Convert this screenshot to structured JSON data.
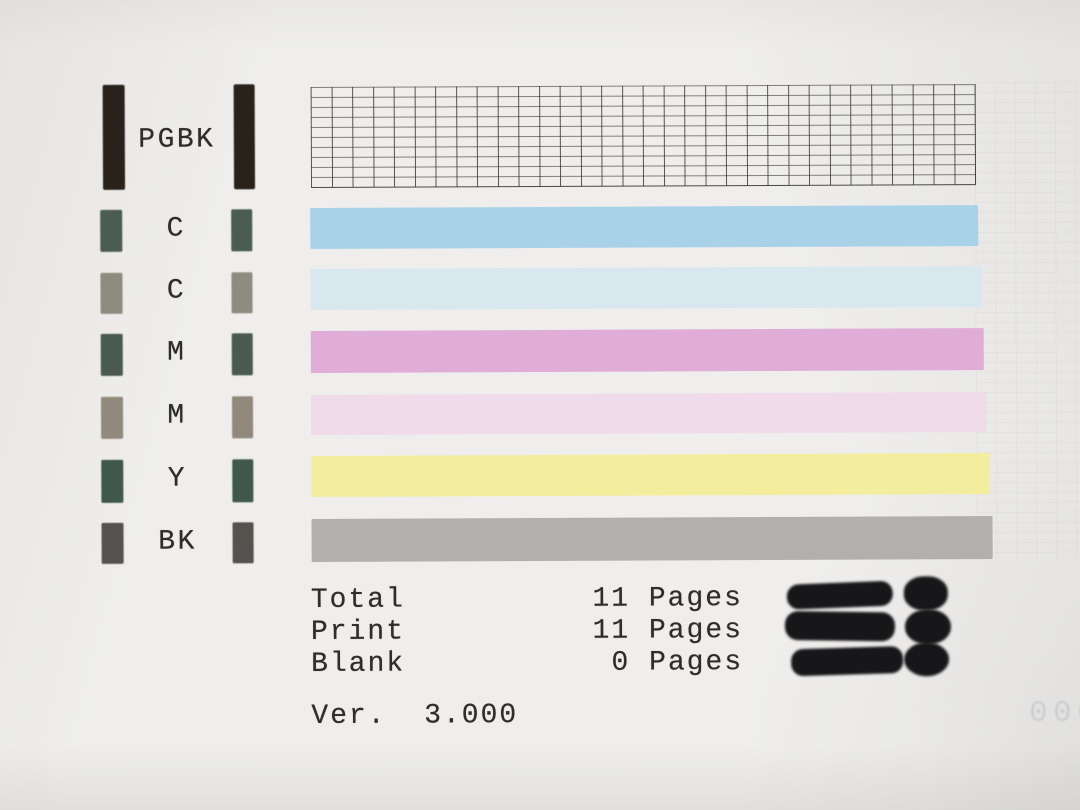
{
  "rows": [
    {
      "label": "PGBK",
      "marker_color": "#28221b",
      "bar_type": "grid"
    },
    {
      "label": "C",
      "marker_color": "#4b5c52",
      "bar_type": "solid",
      "bar_color": "#a9d2e8"
    },
    {
      "label": "C",
      "marker_color": "#8f8b7e",
      "bar_type": "solid",
      "bar_color": "#d9e8ee"
    },
    {
      "label": "M",
      "marker_color": "#4a5a50",
      "bar_type": "solid",
      "bar_color": "#dfadd7"
    },
    {
      "label": "M",
      "marker_color": "#91897c",
      "bar_type": "solid",
      "bar_color": "#efdbea"
    },
    {
      "label": "Y",
      "marker_color": "#3f584a",
      "bar_type": "solid",
      "bar_color": "#f3ee9d"
    },
    {
      "label": "BK",
      "marker_color": "#55524d",
      "bar_type": "solid",
      "bar_color": "#b2b0ae"
    }
  ],
  "stats": {
    "rows": [
      {
        "label": "Total",
        "value": "11 Pages"
      },
      {
        "label": "Print",
        "value": "11 Pages"
      },
      {
        "label": "Blank",
        "value": "0 Pages"
      }
    ]
  },
  "version": "Ver.  3.000",
  "ghost_text": "000",
  "colors": {
    "paper": "#efeeec",
    "ink_black": "#28221b",
    "text_ink": "#2f2d2a",
    "grid_ink": "rgba(62,59,54,0.85)",
    "blob_ink": "#17171a",
    "ghost": "#b9bbc3"
  }
}
